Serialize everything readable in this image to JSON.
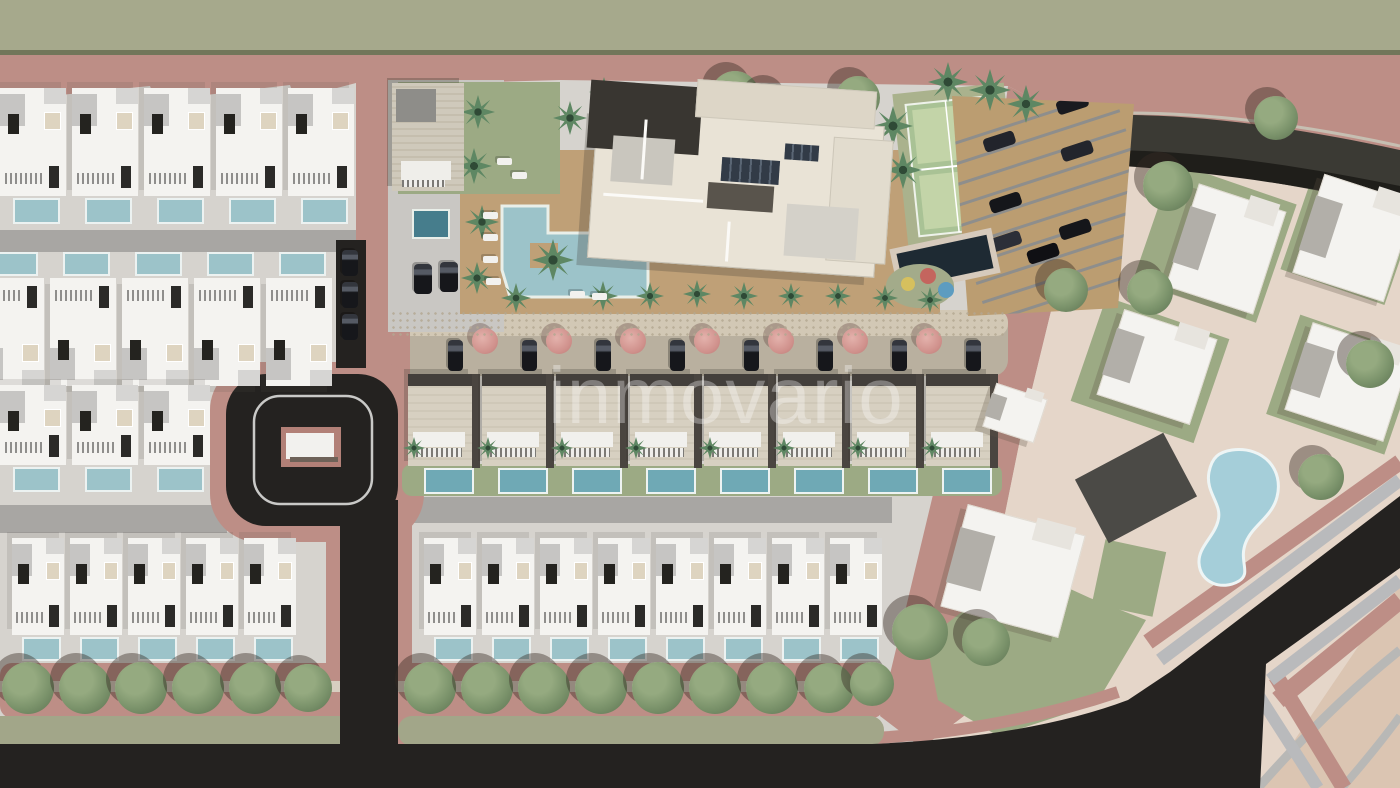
{
  "watermark": {
    "text": "inmovario"
  },
  "site": {
    "description": "Aerial site-plan rendering of a residential development: rows of white detached villas with private pools, a row of stone townhouses, a central apartment building with communal pool, tennis court, playground and parking, a roundabout road loop, tree-lined streets, and an existing neighborhood with a pond to the east",
    "features": [
      "villa-with-pool",
      "townhouse-row",
      "apartment-building",
      "communal-pool",
      "lap-pool",
      "tennis-court",
      "parking-lot",
      "playground",
      "roundabout",
      "street-trees",
      "palm-trees",
      "pond",
      "model-home"
    ],
    "counts": {
      "detached_villas": 26,
      "townhouses": 8,
      "neighborhood_houses": 6,
      "street_trees_bottom_rows": 15,
      "promenade_palms": 10,
      "parked_cars_townhouse_street": 8
    }
  },
  "colors": {
    "olive": "#a6a98c",
    "hedge": "#72765a",
    "rose": "#bd8e86",
    "ground": "#d6d3ce",
    "cream": "#e5d6c9",
    "beige": "#dbc5b2",
    "sage": "#a2a689",
    "sage_lawn": "#9caa84",
    "gray_road": "#a8a6a3",
    "black_road": "#242220",
    "sidewalk": "#b9babc",
    "cobble": "#d2c8b5",
    "street": "#b9b09f",
    "deck_tan": "#bfa077",
    "court_green": "#a9c295",
    "court_light": "#c3d4a8",
    "court_apron": "#aab28d",
    "parking_tan": "#bb9d71",
    "stall": "#8e8e8c",
    "stone": "#d7d0c1",
    "pool": "#9cc3c9",
    "pool_deep": "#6fa9b5",
    "pool_dark": "#1e2a33",
    "pond": "#a5ced9",
    "white": "#f4f3f0",
    "tree": "#7b936b",
    "pink_tree": "#cf908b",
    "palm": "#5e8763",
    "car": "#1b1b1f",
    "island": "#b28077",
    "building_cream": "#e9e3d6",
    "building_dark": "#393631",
    "drive_dark": "#4b4a46",
    "watermark": "rgba(255,255,255,0.32)"
  }
}
